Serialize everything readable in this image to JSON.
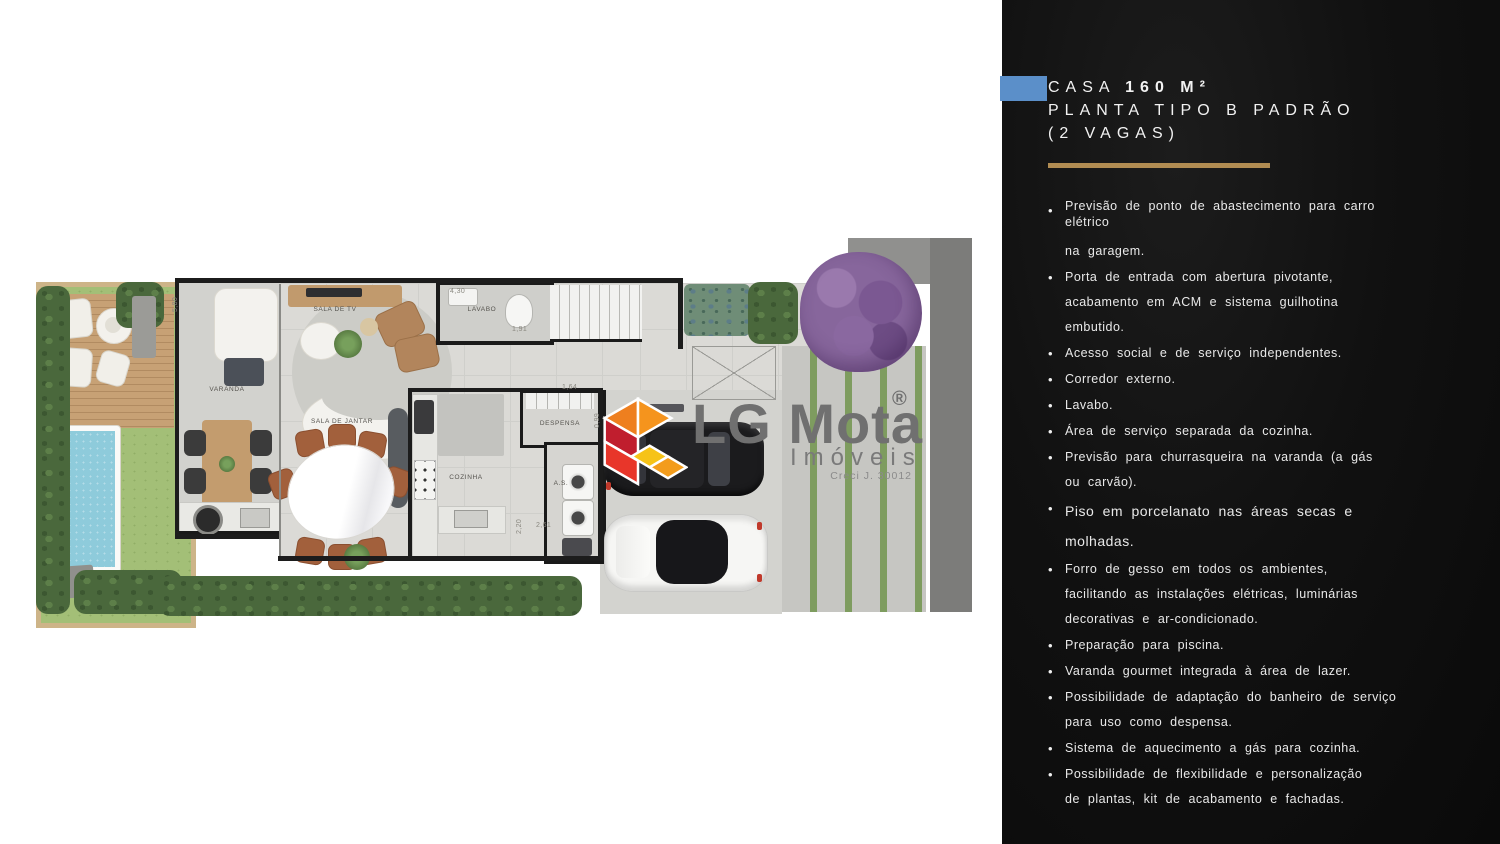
{
  "panel": {
    "accent_color": "#5b8fc9",
    "rule_color": "#b18c52",
    "bullet_char": "•",
    "title": {
      "casa": "CASA ",
      "area": "160 M²",
      "line2": "PLANTA TIPO B PADRÃO",
      "line3": "(2 VAGAS)"
    },
    "features": [
      {
        "lines": [
          "Previsão de ponto de abastecimento para carro",
          "elétrico",
          "na garagem."
        ]
      },
      {
        "lines": [
          "Porta de entrada com abertura pivotante,",
          "acabamento em ACM e sistema guilhotina",
          "embutido."
        ]
      },
      {
        "lines": [
          "Acesso social e de serviço independentes."
        ]
      },
      {
        "lines": [
          "Corredor externo."
        ]
      },
      {
        "lines": [
          "Lavabo."
        ]
      },
      {
        "lines": [
          "Área de serviço separada da cozinha."
        ]
      },
      {
        "lines": [
          "Previsão para churrasqueira na varanda (a gás",
          "ou carvão)."
        ]
      },
      {
        "lines": [
          "Piso em porcelanato nas áreas secas e",
          "molhadas."
        ]
      },
      {
        "lines": [
          "Forro de gesso em todos os ambientes,",
          "facilitando as instalações elétricas,  luminárias",
          "decorativas e ar-condicionado."
        ]
      },
      {
        "lines": [
          "Preparação para piscina."
        ]
      },
      {
        "lines": [
          "Varanda gourmet integrada à área de lazer."
        ]
      },
      {
        "lines": [
          "Possibilidade de adaptação do banheiro de serviço",
          "para uso como despensa."
        ]
      },
      {
        "lines": [
          "Sistema de aquecimento a gás para cozinha."
        ]
      },
      {
        "lines": [
          "Possibilidade de flexibilidade e personalização",
          "de plantas, kit de acabamento e fachadas."
        ]
      }
    ]
  },
  "logo": {
    "name": "LG Mota",
    "mark": "®",
    "subtitle": "Imóveis",
    "license": "Creci J. 30012"
  },
  "plan": {
    "room_labels": {
      "sala_de_tv": "SALA DE TV",
      "varanda": "VARANDA",
      "sala_de_jantar": "SALA DE JANTAR",
      "cozinha": "COZINHA",
      "area_servico": "A.S.",
      "despensa": "DESPENSA",
      "lavabo": "LAVABO"
    },
    "dimensions": {
      "varanda_h": "5,80",
      "sala_tv_w": "4,30",
      "lavabo_w": "1,91",
      "despensa_w": "1,64",
      "despensa_h": "0,99",
      "cozinha_w": "2,61",
      "as_h": "2,20"
    }
  },
  "colors": {
    "panel_bg": "#111111",
    "grass": "#a3bf77",
    "pool_water": "#8ecbdb",
    "deck_wood": "#c7a175",
    "wall": "#1c1c1c",
    "floor_tile": "#dbdad6",
    "tree_purple": "#87669c",
    "logo_orange": "#f5941d",
    "logo_red": "#e8362a",
    "logo_yellow": "#f6c318"
  }
}
